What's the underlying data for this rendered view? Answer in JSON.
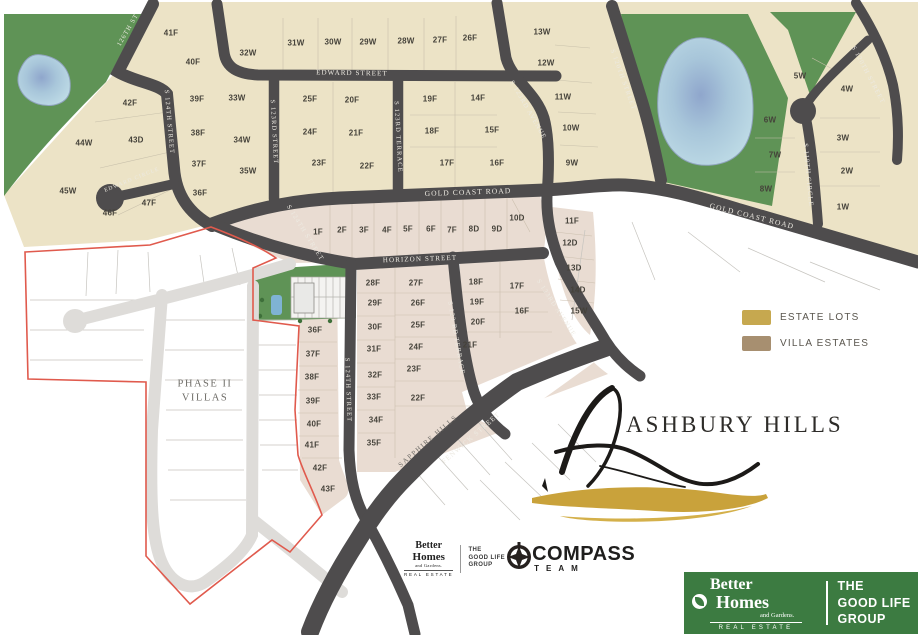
{
  "map": {
    "lots": [
      [
        "41F",
        171,
        33
      ],
      [
        "40F",
        193,
        62
      ],
      [
        "32W",
        248,
        53
      ],
      [
        "31W",
        296,
        43
      ],
      [
        "30W",
        333,
        42
      ],
      [
        "29W",
        368,
        42
      ],
      [
        "28W",
        406,
        41
      ],
      [
        "27F",
        440,
        40
      ],
      [
        "26F",
        470,
        38
      ],
      [
        "13W",
        542,
        32
      ],
      [
        "12W",
        546,
        63
      ],
      [
        "11W",
        563,
        97
      ],
      [
        "10W",
        571,
        128
      ],
      [
        "9W",
        572,
        163
      ],
      [
        "42F",
        130,
        103
      ],
      [
        "39F",
        197,
        99
      ],
      [
        "33W",
        237,
        98
      ],
      [
        "25F",
        310,
        99
      ],
      [
        "20F",
        352,
        100
      ],
      [
        "19F",
        430,
        99
      ],
      [
        "14F",
        478,
        98
      ],
      [
        "44W",
        84,
        143
      ],
      [
        "43D",
        136,
        140
      ],
      [
        "38F",
        198,
        133
      ],
      [
        "34W",
        242,
        140
      ],
      [
        "24F",
        310,
        132
      ],
      [
        "21F",
        356,
        133
      ],
      [
        "18F",
        432,
        131
      ],
      [
        "15F",
        492,
        130
      ],
      [
        "37F",
        199,
        164
      ],
      [
        "35W",
        248,
        171
      ],
      [
        "23F",
        319,
        163
      ],
      [
        "22F",
        367,
        166
      ],
      [
        "17F",
        447,
        163
      ],
      [
        "16F",
        497,
        163
      ],
      [
        "45W",
        68,
        191
      ],
      [
        "36F",
        200,
        193
      ],
      [
        "47F",
        149,
        203
      ],
      [
        "46F",
        110,
        213
      ],
      [
        "5W",
        800,
        76
      ],
      [
        "4W",
        847,
        89
      ],
      [
        "6W",
        770,
        120
      ],
      [
        "3W",
        843,
        138
      ],
      [
        "7W",
        775,
        155
      ],
      [
        "2W",
        847,
        171
      ],
      [
        "8W",
        766,
        189
      ],
      [
        "1W",
        843,
        207
      ],
      [
        "1F",
        318,
        232
      ],
      [
        "2F",
        342,
        230
      ],
      [
        "3F",
        364,
        230
      ],
      [
        "4F",
        387,
        230
      ],
      [
        "5F",
        408,
        229
      ],
      [
        "6F",
        431,
        229
      ],
      [
        "7F",
        452,
        230
      ],
      [
        "8D",
        474,
        229
      ],
      [
        "9D",
        497,
        229
      ],
      [
        "10D",
        517,
        218
      ],
      [
        "11F",
        572,
        221
      ],
      [
        "12D",
        570,
        243
      ],
      [
        "13D",
        574,
        268
      ],
      [
        "14D",
        578,
        290
      ],
      [
        "15W",
        579,
        311
      ],
      [
        "28F",
        373,
        283
      ],
      [
        "27F",
        416,
        283
      ],
      [
        "29F",
        375,
        303
      ],
      [
        "26F",
        418,
        303
      ],
      [
        "30F",
        375,
        327
      ],
      [
        "25F",
        418,
        325
      ],
      [
        "31F",
        374,
        349
      ],
      [
        "24F",
        416,
        347
      ],
      [
        "32F",
        375,
        375
      ],
      [
        "23F",
        414,
        369
      ],
      [
        "33F",
        374,
        397
      ],
      [
        "22F",
        418,
        398
      ],
      [
        "34F",
        376,
        420
      ],
      [
        "35F",
        374,
        443
      ],
      [
        "36F",
        315,
        330
      ],
      [
        "37F",
        313,
        354
      ],
      [
        "38F",
        312,
        377
      ],
      [
        "39F",
        313,
        401
      ],
      [
        "40F",
        314,
        424
      ],
      [
        "41F",
        312,
        445
      ],
      [
        "42F",
        320,
        468
      ],
      [
        "43F",
        328,
        489
      ],
      [
        "18F",
        476,
        282
      ],
      [
        "17F",
        517,
        286
      ],
      [
        "19F",
        477,
        302
      ],
      [
        "16F",
        522,
        311
      ],
      [
        "20F",
        478,
        322
      ],
      [
        "21F",
        470,
        345
      ]
    ],
    "streets": [
      [
        "126TH ST",
        128,
        30,
        -60,
        6.5
      ],
      [
        "S 124TH STREET",
        169,
        122,
        85,
        6.5
      ],
      [
        "EDWARD CIRCLE",
        132,
        180,
        -22,
        5.5
      ],
      [
        "EDWARD STREET",
        352,
        73,
        1,
        7
      ],
      [
        "S 123RD STREET",
        274,
        132,
        87,
        6.5
      ],
      [
        "S 123RD TERRACE",
        398,
        137,
        87,
        6.5
      ],
      [
        "S 123RD AVENUE",
        528,
        110,
        60,
        6.5
      ],
      [
        "S 120TH STREET",
        623,
        80,
        70,
        6.5
      ],
      [
        "S 120TH STREET",
        868,
        75,
        62,
        6.5
      ],
      [
        "S 119TH CIRCLE",
        808,
        175,
        85,
        6.5
      ],
      [
        "GOLD COAST ROAD",
        468,
        192,
        -2,
        7.5
      ],
      [
        "GOLD COAST ROAD",
        752,
        216,
        14,
        7.5
      ],
      [
        "S 124TH STREET",
        305,
        233,
        58,
        6.5
      ],
      [
        "HORIZON STREET",
        420,
        259,
        -2,
        7
      ],
      [
        "S 124TH STREET",
        348,
        390,
        88,
        6.5
      ],
      [
        "S 123 RD TERRACE",
        456,
        338,
        80,
        6.5
      ],
      [
        "S 123RD AVENUE",
        556,
        308,
        57,
        6.5
      ],
      [
        "FENWICK STREET",
        471,
        438,
        -41,
        7
      ]
    ],
    "area_labels": [
      [
        "PHASE II",
        205,
        384,
        0,
        10.5
      ],
      [
        "VILLAS",
        205,
        398,
        0,
        10.5
      ],
      [
        "SAPPHIRE HILLS",
        428,
        441,
        -41,
        7
      ]
    ]
  },
  "legend": {
    "items": [
      {
        "label": "ESTATE LOTS",
        "color": "#c6a84f"
      },
      {
        "label": "VILLA ESTATES",
        "color": "#a78f70"
      }
    ]
  },
  "logo": {
    "wordmark": "ASHBURY HILLS"
  },
  "branding": {
    "bhg_small": {
      "line1": "Better",
      "line2": "Homes",
      "line3": "and Gardens.",
      "line4": "REAL ESTATE"
    },
    "glg_small": {
      "line1": "THE",
      "line2": "GOOD LIFE",
      "line3": "GROUP"
    },
    "compass": {
      "title": "COMPASS",
      "subtitle": "TEAM"
    },
    "bhg_box": {
      "better": "Better",
      "homes": "Homes",
      "and_gardens": "and Gardens.",
      "real_estate": "REAL ESTATE",
      "group1": "THE",
      "group2": "GOOD LIFE",
      "group3": "GROUP"
    }
  },
  "colors": {
    "estate_fill": "#ece3c6",
    "villa_fill": "#e9dcd2",
    "road_dark": "#4e4c4d",
    "road_gray": "#dedcd9",
    "green": "#5f9356",
    "pond": "#b9d7e2",
    "boundary_red": "#e05a4d",
    "bhg_green": "#3c7b41"
  }
}
